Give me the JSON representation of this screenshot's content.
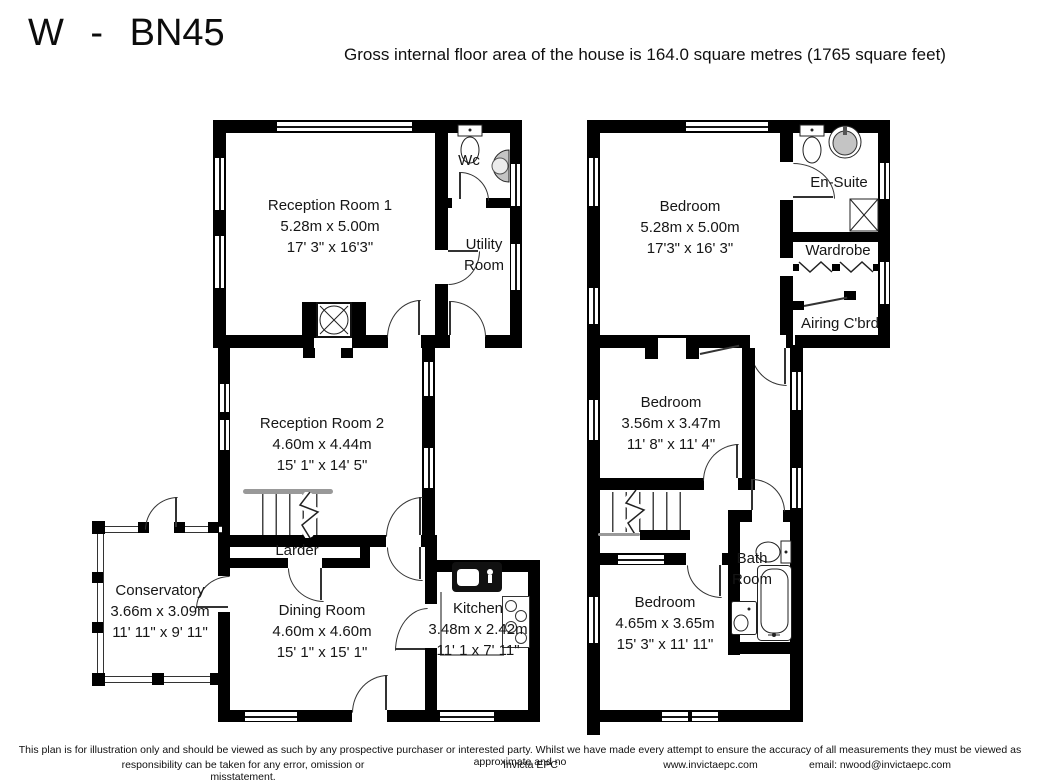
{
  "header": {
    "title": "W - BN45",
    "subtitle": "Gross internal floor area of the house is 164.0 square metres (1765 square feet)"
  },
  "ground_floor": {
    "rooms": {
      "reception1": {
        "name": "Reception Room 1",
        "metric": "5.28m x 5.00m",
        "imperial": "17' 3\" x 16'3\""
      },
      "wc": {
        "name": "Wc"
      },
      "utility": {
        "line1": "Utility",
        "line2": "Room"
      },
      "reception2": {
        "name": "Reception Room 2",
        "metric": "4.60m x 4.44m",
        "imperial": "15' 1\" x 14' 5\""
      },
      "larder": {
        "name": "Larder"
      },
      "conservatory": {
        "name": "Conservatory",
        "metric": "3.66m x 3.09m",
        "imperial": "11' 11\" x 9' 11\""
      },
      "dining": {
        "name": "Dining Room",
        "metric": "4.60m x 4.60m",
        "imperial": "15' 1\" x 15' 1\""
      },
      "kitchen": {
        "name": "Kitchen",
        "metric": "3.48m x 2.42m",
        "imperial": "11' 1 x 7' 11\""
      }
    }
  },
  "first_floor": {
    "rooms": {
      "bedroom1": {
        "name": "Bedroom",
        "metric": "5.28m x 5.00m",
        "imperial": "17'3\" x 16' 3\""
      },
      "ensuite": {
        "name": "En-Suite"
      },
      "wardrobe": {
        "name": "Wardrobe"
      },
      "airing": {
        "name": "Airing C'brd"
      },
      "bedroom2": {
        "name": "Bedroom",
        "metric": "3.56m x 3.47m",
        "imperial": "11' 8\" x 11' 4\""
      },
      "bathroom": {
        "line1": "Bath",
        "line2": "Room"
      },
      "bedroom3": {
        "name": "Bedroom",
        "metric": "4.65m x 3.65m",
        "imperial": "15' 3\" x 11' 11\""
      }
    }
  },
  "footer": {
    "line1": "This plan is for illustration only and should be viewed as such by any prospective purchaser or interested party. Whilst we have made every attempt to ensure the accuracy of all measurements they must be viewed as approximate and no",
    "line2": "responsibility can be taken for any error, omission or misstatement.",
    "company": "Invicta EPC",
    "website": "www.invictaepc.com",
    "email": "email: nwood@invictaepc.com"
  },
  "colors": {
    "wall": "#000000",
    "text": "#161616",
    "door_line": "#333333",
    "fixture_gray": "#c4c4c4"
  }
}
